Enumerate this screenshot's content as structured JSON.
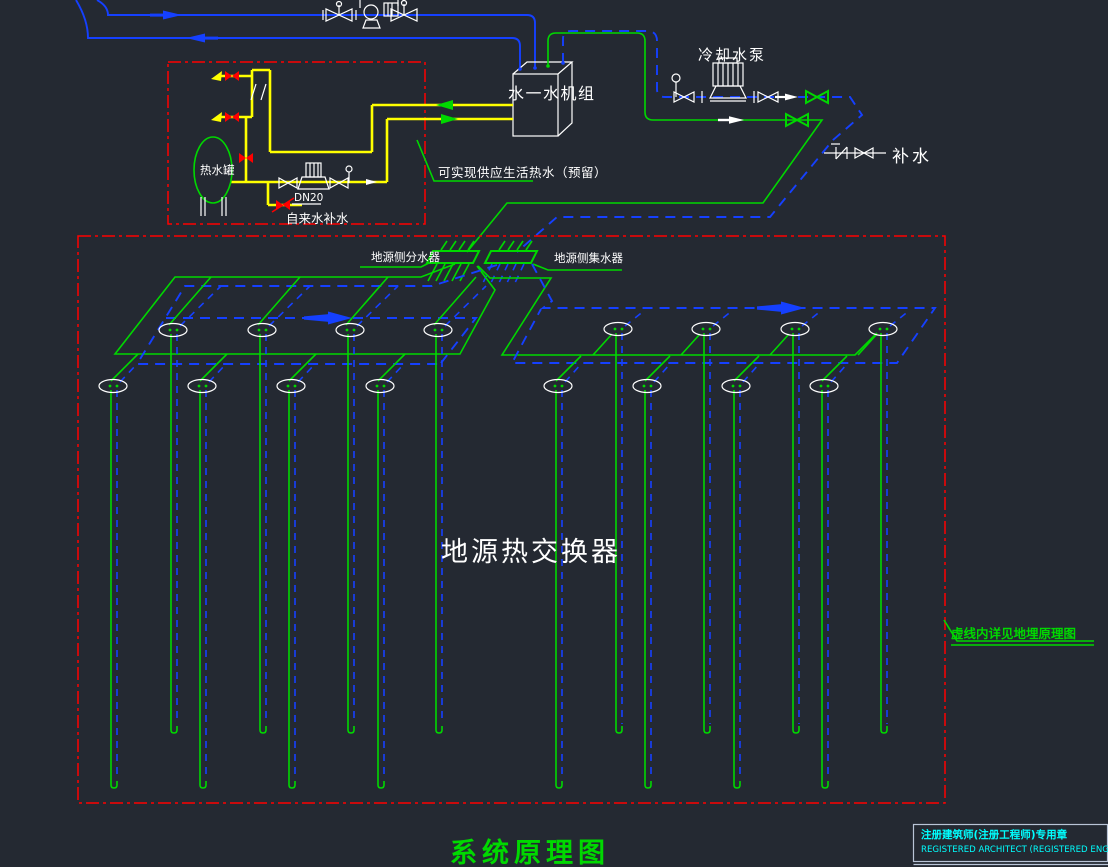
{
  "palette": {
    "background": "#242932",
    "green": "#00d800",
    "blue": "#1540ff",
    "red": "#ff0000",
    "yellow": "#ffff00",
    "white": "#ffffff",
    "cyan": "#00ffff"
  },
  "labels": {
    "cooling_pump": "冷却水泵",
    "unit": "水一水机组",
    "makeup_water": "补水",
    "hot_water_tank": "热水罐",
    "pipe_dn": "DN20",
    "tap_water_makeup": "自来水补水",
    "dhw_note": "可实现供应生活热水（预留）",
    "supply_manifold": "地源侧分水器",
    "return_manifold": "地源侧集水器",
    "ground_hx": "地源热交换器",
    "dashed_note": "虚线内详见地埋原理图",
    "title": "系统原理图",
    "stamp_line1": "注册建筑师(注册工程师)专用章",
    "stamp_line2": "REGISTERED ARCHITECT (REGISTERED ENGINEER) STAMP"
  },
  "ground_loops": {
    "groups": [
      {
        "name": "left",
        "upper": {
          "xs": [
            173,
            262,
            350,
            438
          ],
          "cy": 330,
          "depth": 733
        },
        "lower": {
          "xs": [
            113,
            202,
            291,
            380
          ],
          "cy": 386,
          "depth": 788
        }
      },
      {
        "name": "right",
        "upper": {
          "xs": [
            618,
            706,
            795,
            883
          ],
          "cy": 329,
          "depth": 733
        },
        "lower": {
          "xs": [
            558,
            647,
            736,
            824
          ],
          "cy": 386,
          "depth": 788
        }
      }
    ]
  }
}
